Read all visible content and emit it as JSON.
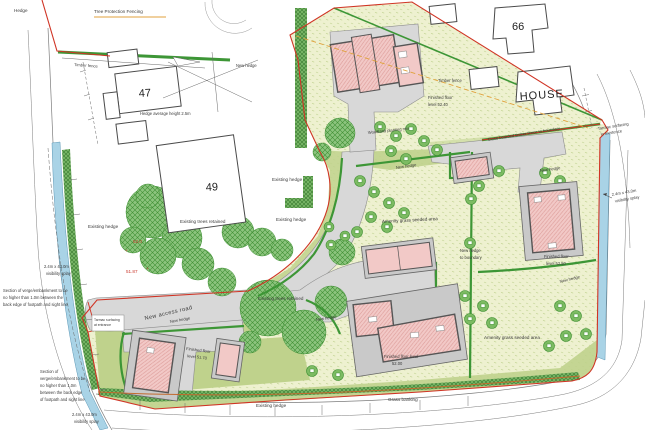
{
  "site_plan": {
    "existing_buildings": {
      "no47": "47",
      "no49": "49",
      "no66": "66",
      "house": "HOUSE"
    },
    "fencing": {
      "hedge": "Hedge",
      "tree_protection": "Tree Protection Fencing",
      "timber_fence": "Timber fence",
      "hedge_average_height": "Hedge average height 2.5m",
      "close_boarded": "Close boarded timber fence to boundary"
    },
    "landscape": {
      "existing_hedge": "Existing hedge",
      "new_hedge": "New hedge",
      "new_hedge_boundary_l1": "New hedge",
      "new_hedge_boundary_l2": "to boundary",
      "existing_trees": "Existing trees retained",
      "woodland_planting": "Woodland planting mix",
      "amenity_grass": "Amenity grass seeded area",
      "grass_banking": "Grass banking"
    },
    "roads": {
      "new_access_road": "New access road",
      "tarmac_l1": "Tarmac surfacing",
      "tarmac_left_l2": "at entrance",
      "tarmac_right_l2": "in existence",
      "splay_l1": "2.4m x 43.0m",
      "splay_l2": "visibility splay"
    },
    "levels": {
      "ffl_l1": "Finished floor",
      "ffl1_l2": "level 52.40",
      "ffl2_l2": "level 52.50",
      "ffl3_l1": "Finished floor level",
      "ffl3_l2": "52.00",
      "ffl4_l2": "level 51.70",
      "spot_52_0": "52.0",
      "spot_51_87": "51.87"
    },
    "notes": {
      "verge_upper_l1": "Section of verge/embankment to be",
      "verge_upper_l2": "no higher than 1.0m between the",
      "verge_upper_l3": "back edge of footpath and sight line",
      "verge_lower_l1": "Section of",
      "verge_lower_l2": "verge/embankment to be",
      "verge_lower_l3": "no higher than 1.0m",
      "verge_lower_l4": "between the back edge",
      "verge_lower_l5": "of footpath and sight line"
    },
    "colors": {
      "boundary_red": "#d03425",
      "amenity_grass": "#eef1d0",
      "hedge_green": "#3d9636",
      "tree_green": "#57a649",
      "road_grey": "#d8d8d8",
      "building_pink": "#f2c9c7",
      "roof_hatch": "#d99591",
      "footway_blue": "#a9d3e6",
      "protection_orange": "#e0a23c"
    }
  }
}
